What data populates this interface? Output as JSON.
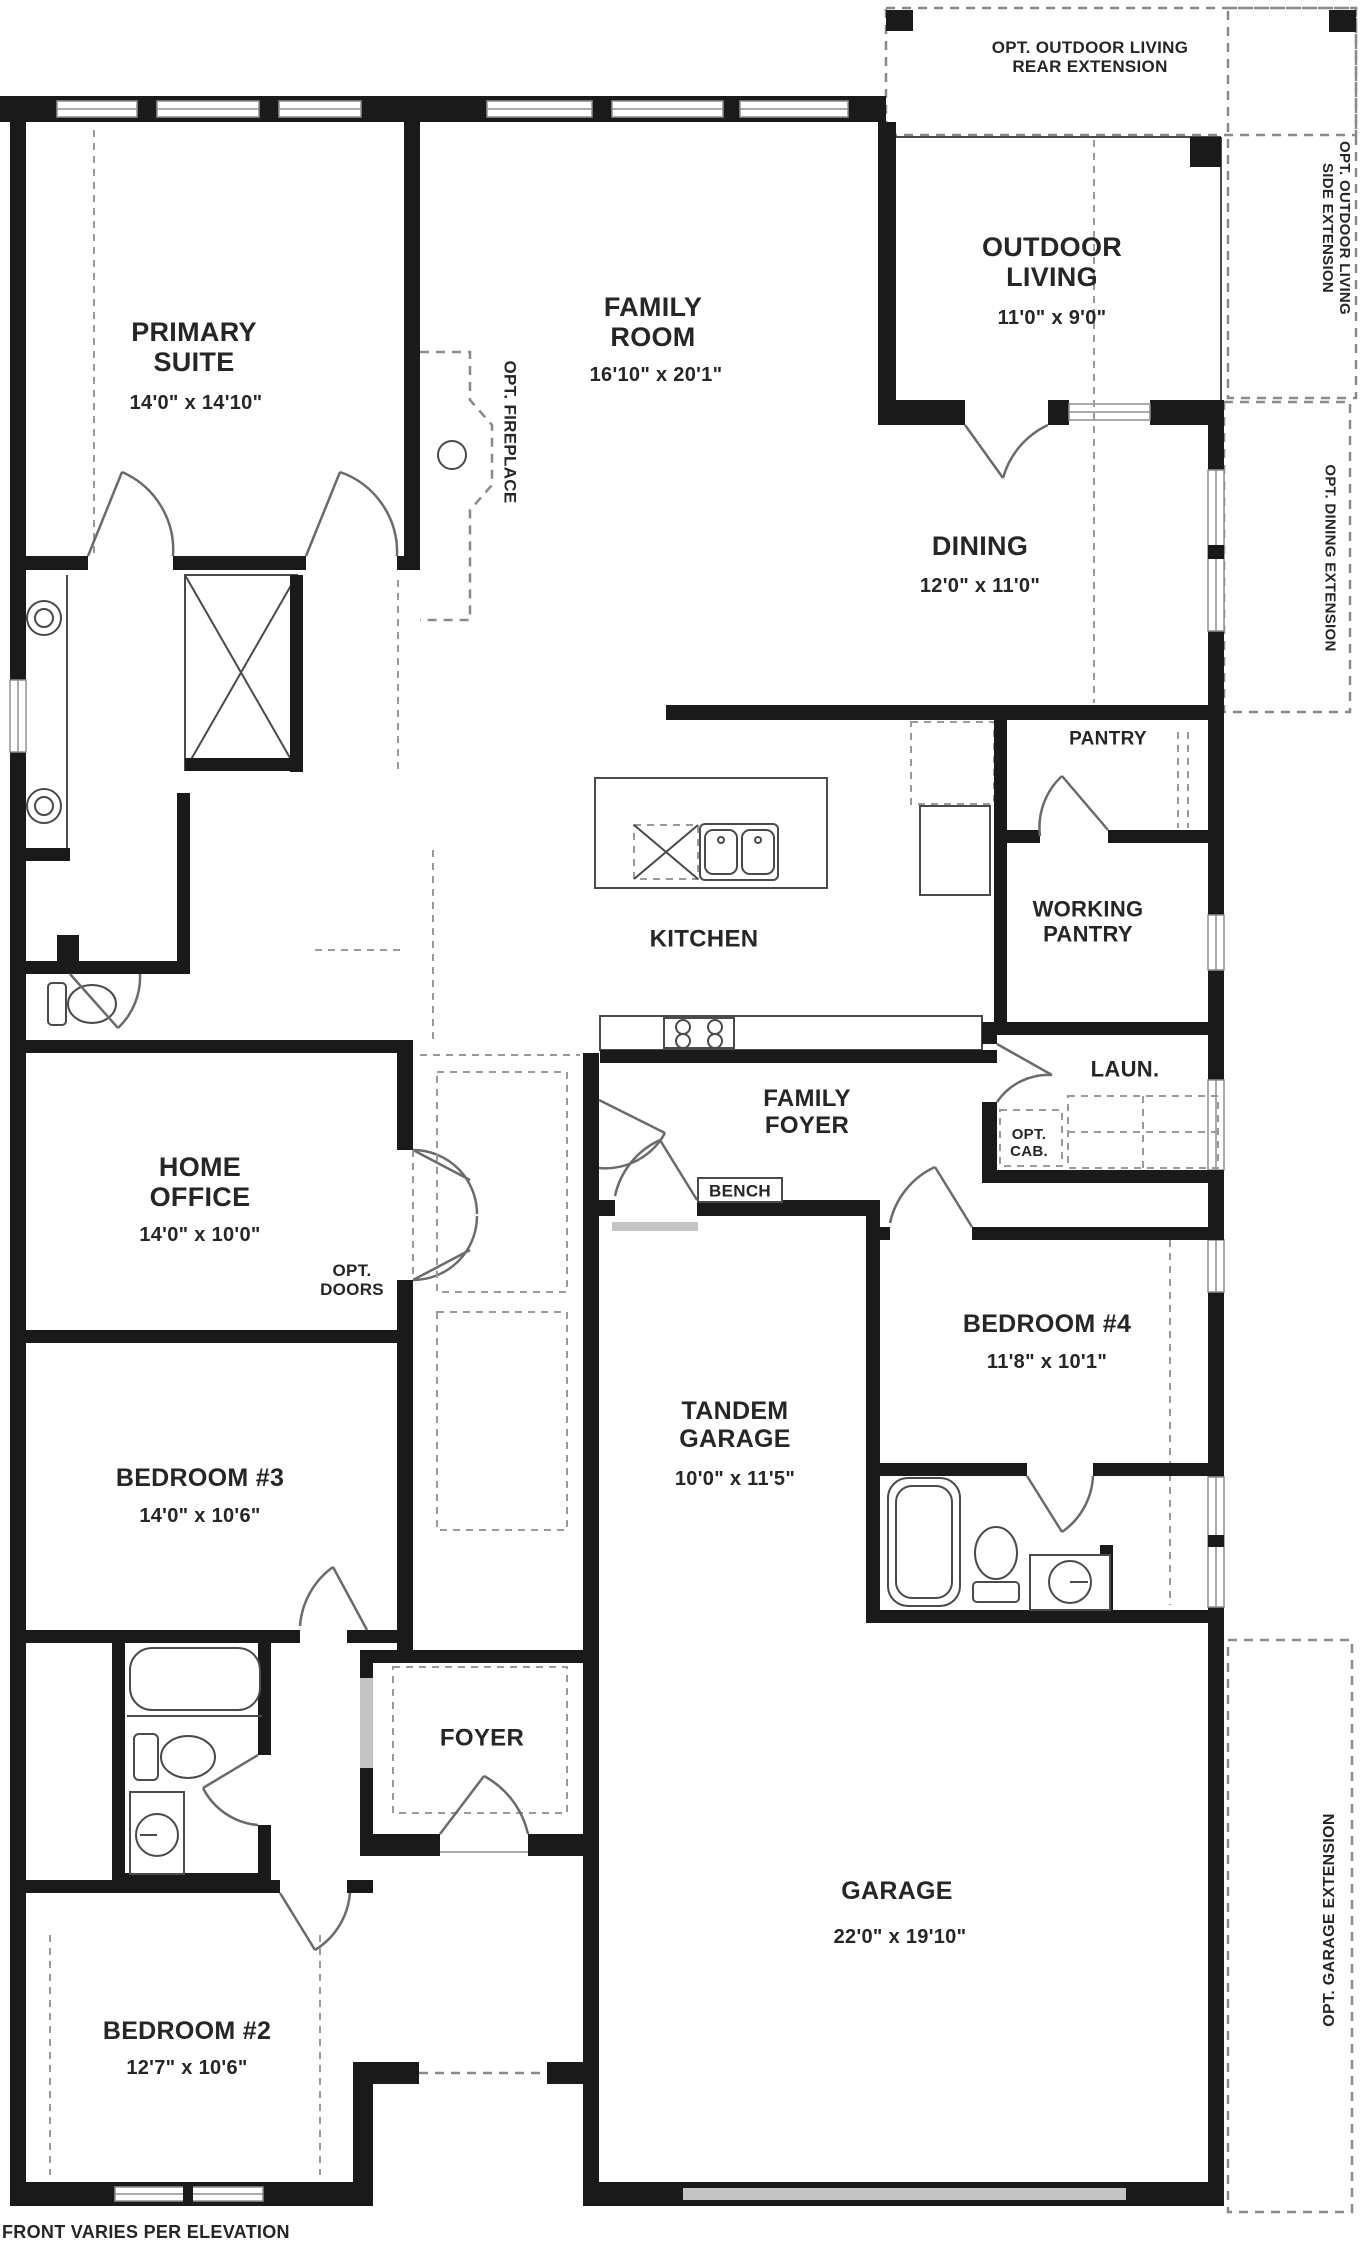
{
  "plan": {
    "title_note": "FRONT VARIES PER ELEVATION",
    "colors": {
      "wall": "#1a1a1a",
      "window_frame": "#8f8f8f",
      "dashed_option": "#8a8a8a",
      "door_swing": "#6b6b6b",
      "garage_door": "#c4c4c4",
      "text": "#262626"
    },
    "rooms": {
      "primary": {
        "name": "PRIMARY\nSUITE",
        "dims": "14'0\" x 14'10\""
      },
      "family": {
        "name": "FAMILY\nROOM",
        "dims": "16'10\" x 20'1\""
      },
      "outdoor": {
        "name": "OUTDOOR\nLIVING",
        "dims": "11'0\" x 9'0\""
      },
      "dining": {
        "name": "DINING",
        "dims": "12'0\" x 11'0\""
      },
      "kitchen": {
        "name": "KITCHEN"
      },
      "pantry": {
        "name": "PANTRY"
      },
      "working_pantry": {
        "name": "WORKING\nPANTRY"
      },
      "laundry": {
        "name": "LAUN."
      },
      "family_foyer": {
        "name": "FAMILY\nFOYER"
      },
      "bench": {
        "name": "BENCH"
      },
      "home_office": {
        "name": "HOME\nOFFICE",
        "dims": "14'0\" x 10'0\""
      },
      "bedroom4": {
        "name": "BEDROOM #4",
        "dims": "11'8\" x 10'1\""
      },
      "tandem_garage": {
        "name": "TANDEM\nGARAGE",
        "dims": "10'0\" x 11'5\""
      },
      "bedroom3": {
        "name": "BEDROOM #3",
        "dims": "14'0\" x 10'6\""
      },
      "foyer": {
        "name": "FOYER"
      },
      "garage": {
        "name": "GARAGE",
        "dims": "22'0\" x 19'10\""
      },
      "bedroom2": {
        "name": "BEDROOM #2",
        "dims": "12'7\" x 10'6\""
      }
    },
    "options": {
      "outdoor_rear": {
        "label": "OPT. OUTDOOR LIVING\nREAR EXTENSION"
      },
      "outdoor_side": {
        "label": "OPT. OUTDOOR LIVING\nSIDE EXTENSION"
      },
      "dining_ext": {
        "label": "OPT. DINING EXTENSION"
      },
      "fireplace": {
        "label": "OPT. FIREPLACE"
      },
      "cabinets": {
        "label": "OPT.\nCAB."
      },
      "doors": {
        "label": "OPT.\nDOORS"
      },
      "garage_ext": {
        "label": "OPT. GARAGE EXTENSION"
      }
    }
  }
}
